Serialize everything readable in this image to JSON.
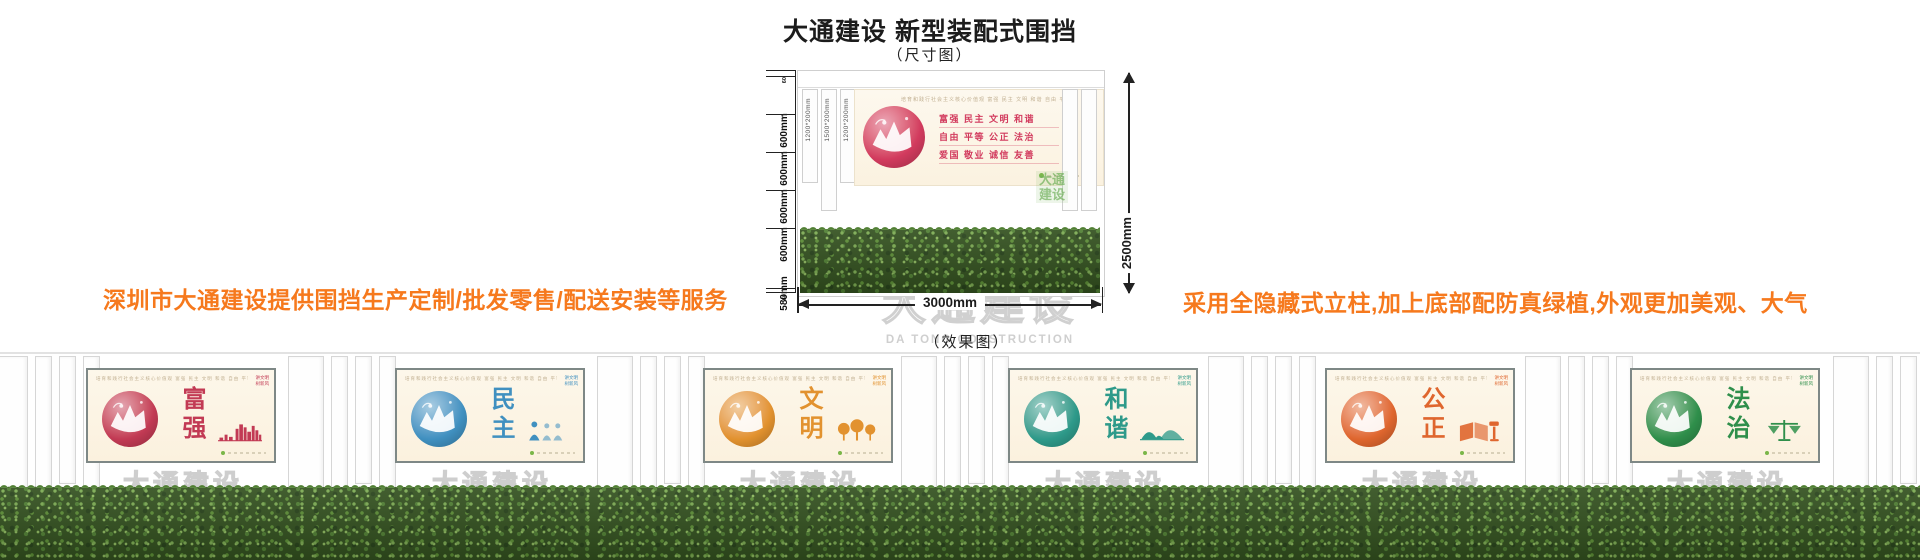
{
  "page": {
    "title": "大通建设 新型装配式围挡",
    "subtitle": "（尺寸图）",
    "effect_label": "（效果图）",
    "left_note": "深圳市大通建设提供围挡生产定制/批发零售/配送安装等服务",
    "right_note": "采用全隐藏式立柱,加上底部配防真绿植,外观更加美观、大气",
    "note_color": "#f6791d"
  },
  "watermark": {
    "cn": "大通建设",
    "en": "DA TONG CONSTRUCTION"
  },
  "diagram": {
    "total_height_label": "2500mm",
    "total_width_label": "3000mm",
    "height_segments": [
      "60",
      "600mm",
      "600mm",
      "600mm",
      "600mm",
      "580mm",
      "60"
    ],
    "post_labels": [
      "1200*200mm",
      "1500*200mm",
      "1200*200mm"
    ],
    "panel": {
      "header": "培育和践行社会主义核心价值观  富强 民主 文明 和谐 自由 平等 公正 法治 爱国 敬业 诚信 友善",
      "slogan_lines": [
        "富强  民主  文明  和谐",
        "自由  平等  公正  法治",
        "爱国  敬业  诚信  友善"
      ],
      "corner_lines": [
        "讲文明",
        "树新风"
      ],
      "accent": "#d23b5e",
      "background": "#fdf7ea"
    },
    "green_mark_lines": [
      "大通",
      "建设"
    ],
    "green_mark_color": "#6eaf58"
  },
  "effect": {
    "panel_common": {
      "header": "培育和践行社会主义核心价值观  富强 民主 文明 和谐 自由 平等 公正 法治 爱国 敬业 诚信 友善",
      "corner_lines": [
        "讲文明",
        "树新风"
      ],
      "background": "#fdf7ea"
    },
    "panels": [
      {
        "title": "富强",
        "accent": "#c23a54",
        "icon": "city-skyline-icon"
      },
      {
        "title": "民主",
        "accent": "#4090c0",
        "icon": "people-icon"
      },
      {
        "title": "文明",
        "accent": "#e2922f",
        "icon": "trees-icon"
      },
      {
        "title": "和谐",
        "accent": "#2e9a8a",
        "icon": "mountains-icon"
      },
      {
        "title": "公正",
        "accent": "#df662e",
        "icon": "book-gavel-icon"
      },
      {
        "title": "法治",
        "accent": "#2f8f4b",
        "icon": "scales-icon"
      }
    ],
    "grass_colors": {
      "base": "#33511f",
      "mid": "#507f33",
      "light": "#7cab52"
    }
  }
}
